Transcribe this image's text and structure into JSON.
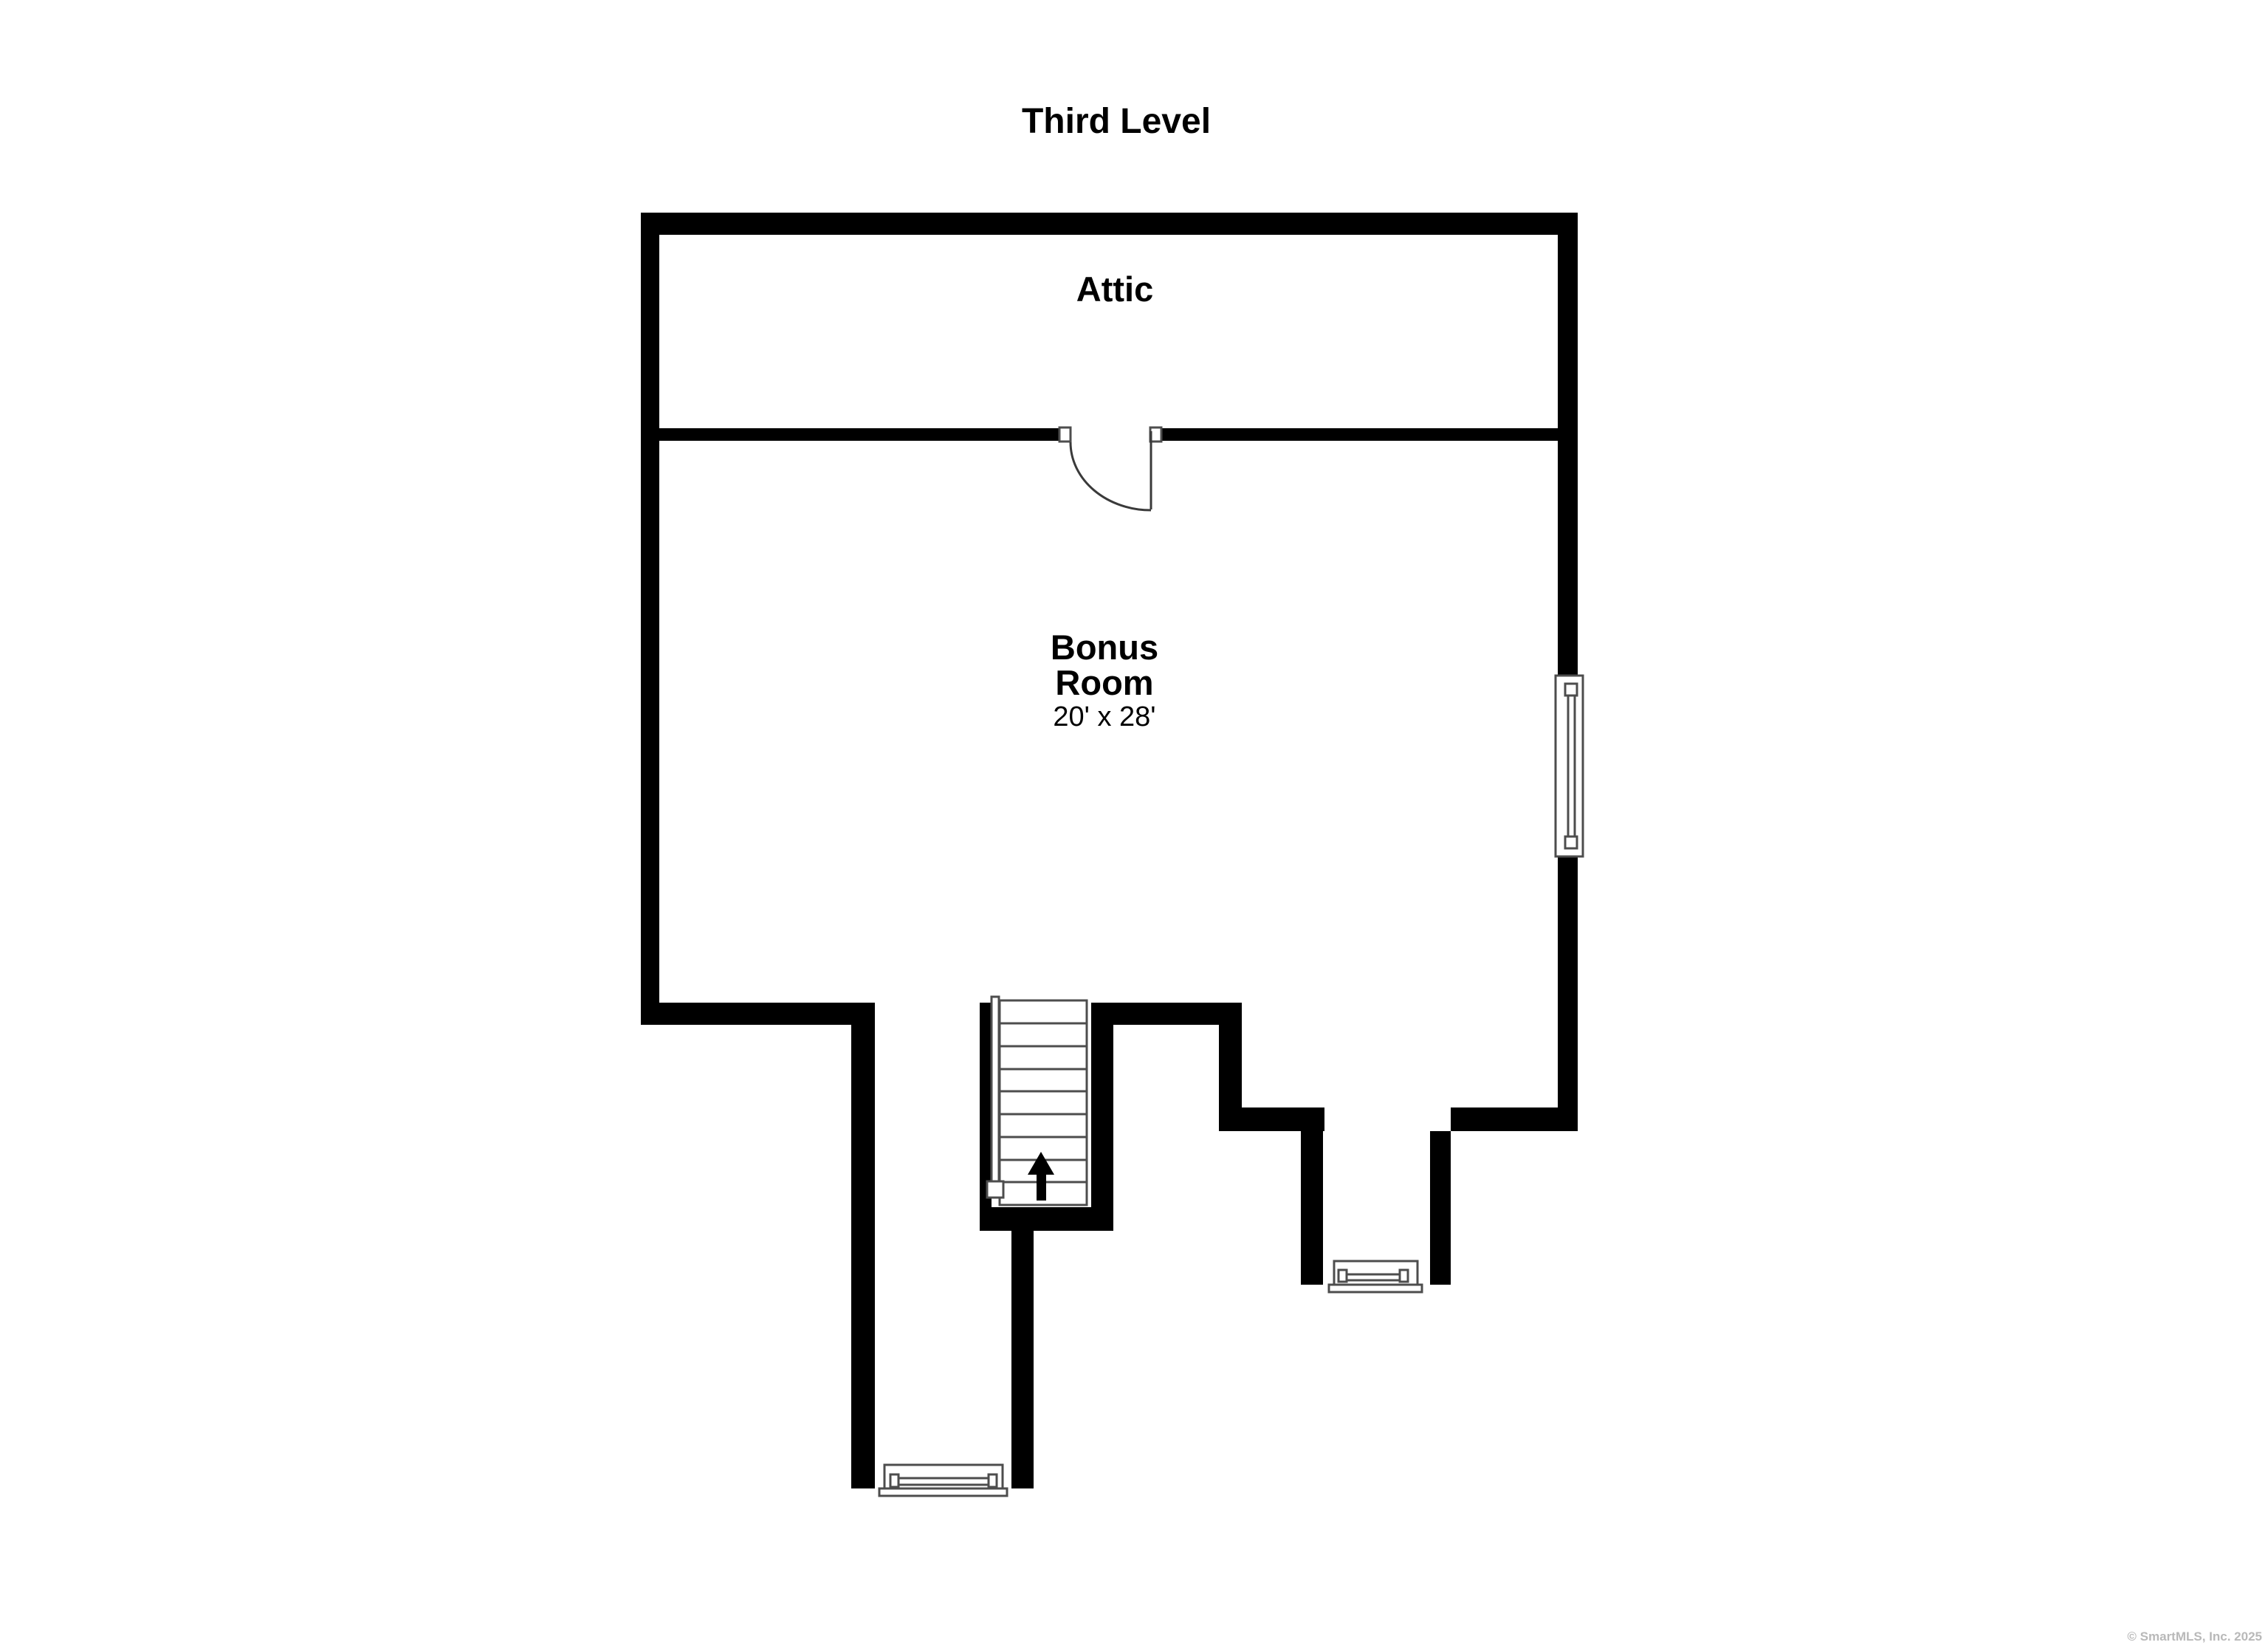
{
  "page": {
    "background": "#ffffff"
  },
  "floorplan": {
    "title": "Third Level",
    "rooms": [
      {
        "name": "attic",
        "label": "Attic"
      },
      {
        "name": "bonus-room",
        "label_line1": "Bonus",
        "label_line2": "Room",
        "dimensions": "20' x 28'"
      }
    ],
    "features": {
      "stairs": {
        "tread_count": 9,
        "direction": "up",
        "arrow_icon": "up-arrow"
      },
      "door": {
        "type": "hinged-swing-door",
        "location": "wall between Attic and Bonus Room"
      },
      "windows": [
        {
          "location": "right wall of Bonus Room",
          "orientation": "vertical"
        },
        {
          "location": "bottom of right lower corridor",
          "orientation": "horizontal"
        },
        {
          "location": "bottom of left lower hallway",
          "orientation": "horizontal"
        }
      ]
    },
    "colors": {
      "wall": "#000000",
      "floor": "#ffffff",
      "outline": "#4d4d4d"
    }
  },
  "watermark": {
    "text": "© SmartMLS, Inc.  2025",
    "color": "#b9b9b9"
  }
}
